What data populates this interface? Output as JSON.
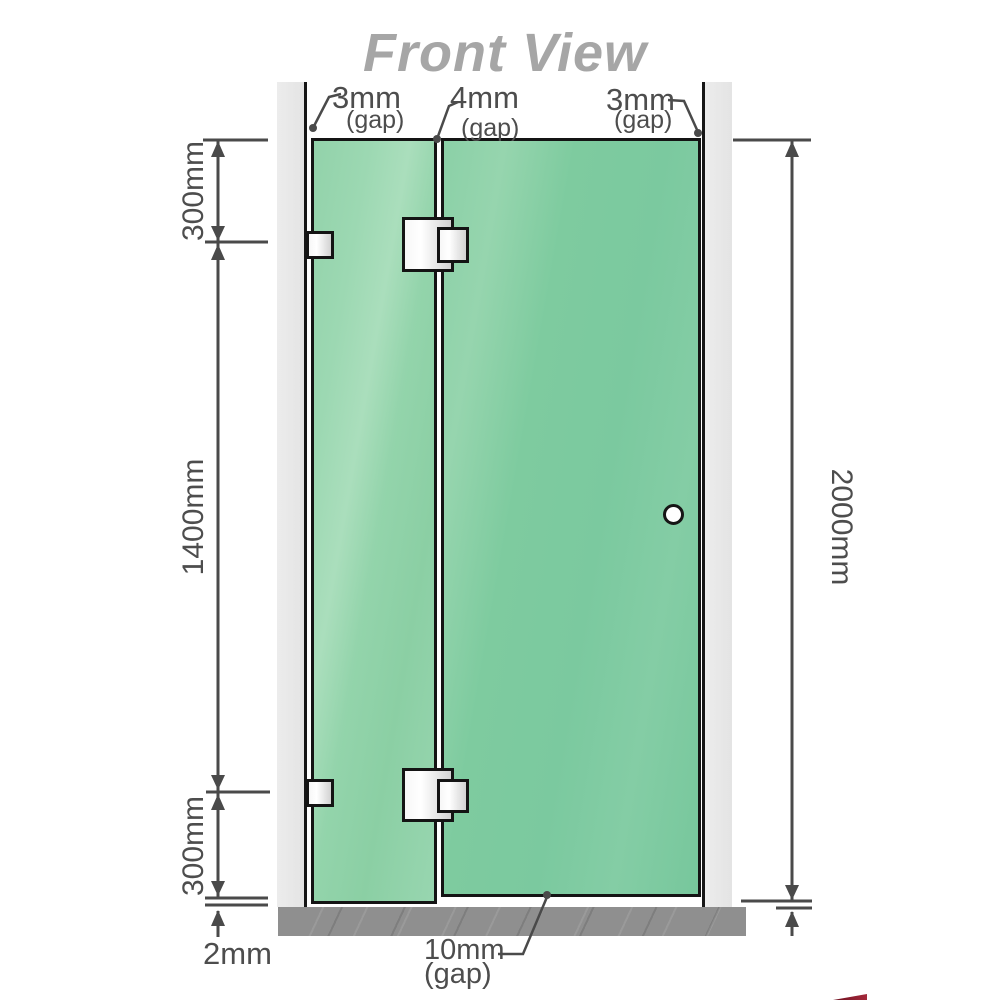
{
  "title": "Front View",
  "labels": {
    "gap_left": {
      "value": "3mm",
      "unit": "(gap)"
    },
    "gap_middle": {
      "value": "4mm",
      "unit": "(gap)"
    },
    "gap_right": {
      "value": "3mm",
      "unit": "(gap)"
    },
    "gap_bottom": {
      "value": "10mm",
      "unit": "(gap)"
    }
  },
  "dimensions": {
    "top_section": "300mm",
    "middle_section": "1400mm",
    "bottom_section": "300mm",
    "total_height": "2000mm",
    "floor_gap": "2mm"
  },
  "colors": {
    "glass_fixed": "#9cd8b2",
    "glass_door": "#7ecb9f",
    "wall": "#e8e8e8",
    "floor": "#8f8f8f",
    "dimension_line": "#4a4a4a",
    "label_text": "#4d4d4d",
    "title_text": "#a6a6a6"
  }
}
